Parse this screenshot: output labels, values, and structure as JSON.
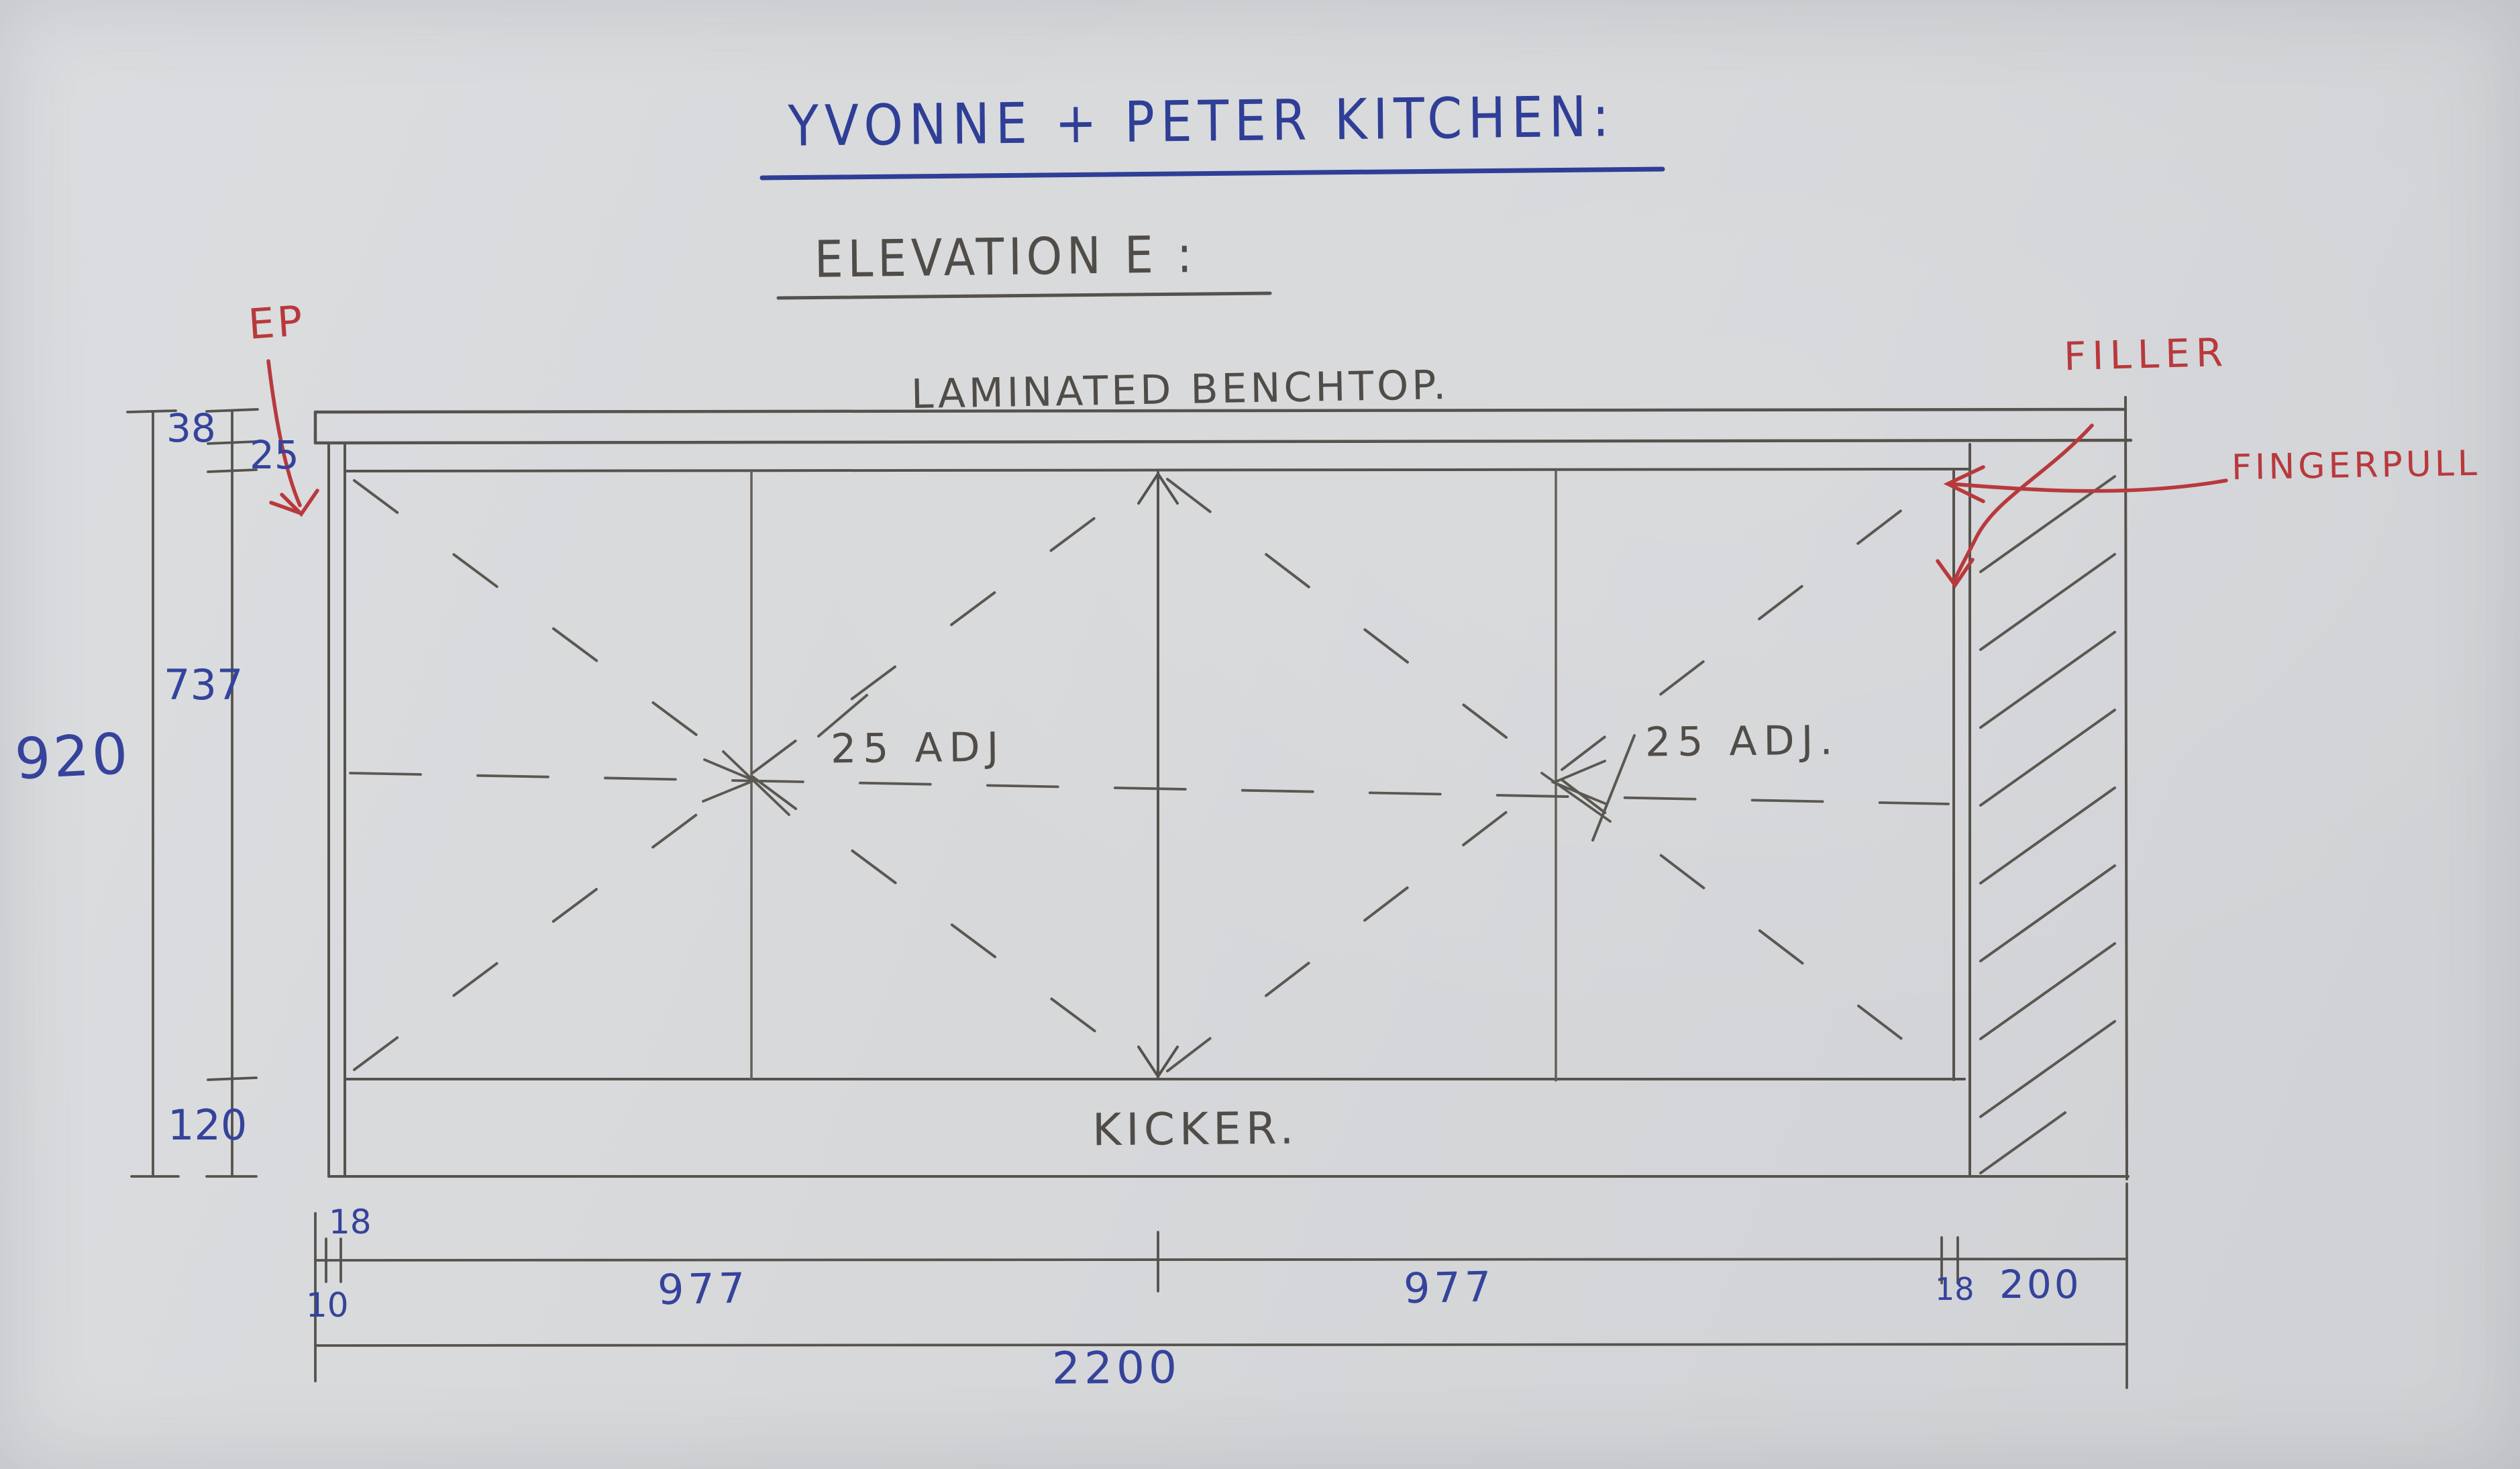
{
  "sheet": {
    "title": "YVONNE + PETER KITCHEN:",
    "subtitle": "ELEVATION E :",
    "annotations": {
      "benchtop": "LAMINATED BENCHTOP.",
      "kicker": "KICKER.",
      "end_panel": "EP",
      "filler": "FILLER",
      "fingerpull": "FINGERPULL",
      "shelf_left": "25 ADJ",
      "shelf_right": "25 ADJ."
    },
    "dimensions": {
      "benchtop_thickness": "38",
      "fingerpull_gap": "25",
      "door_height": "737",
      "overall_height": "920",
      "kicker_height": "120",
      "left_gap": "10",
      "left_panel": "18",
      "bay_left_width": "977",
      "bay_right_width": "977",
      "right_panel": "18",
      "filler_width": "200",
      "overall_width": "2200"
    },
    "colors": {
      "ink_blue": "#2f3e96",
      "pencil": "#504c47",
      "red_pen": "#b8393c",
      "paper": "#d6d8da"
    }
  }
}
